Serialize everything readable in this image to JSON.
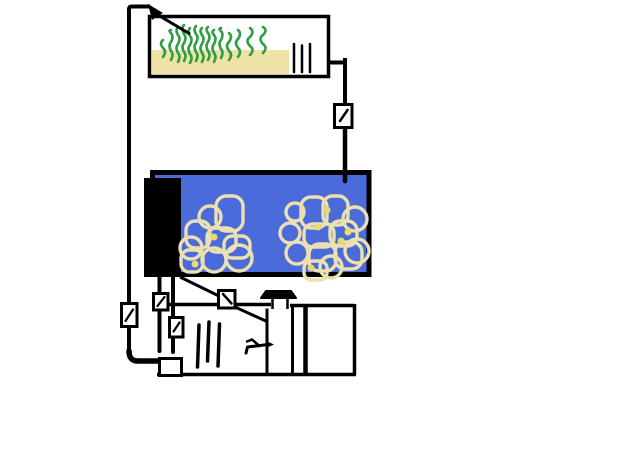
{
  "canvas": {
    "width": 640,
    "height": 461,
    "background": "#ffffff"
  },
  "colors": {
    "line": "#000000",
    "water": "#4a6bd9",
    "substrate": "#efe2a7",
    "rock_outline": "#ebe0af",
    "rock_highlight": "#e8da6e",
    "plant_green": "#2f9e44",
    "box_fill": "#ffffff"
  },
  "plants": [
    {
      "x": 163,
      "y1": 40,
      "y2": 57,
      "a": 4
    },
    {
      "x": 171,
      "y1": 30,
      "y2": 60,
      "a": 3
    },
    {
      "x": 178,
      "y1": 27,
      "y2": 62,
      "a": 3
    },
    {
      "x": 184,
      "y1": 25,
      "y2": 61,
      "a": 3
    },
    {
      "x": 190,
      "y1": 28,
      "y2": 63,
      "a": 3
    },
    {
      "x": 196,
      "y1": 26,
      "y2": 61,
      "a": 3
    },
    {
      "x": 202,
      "y1": 28,
      "y2": 62,
      "a": 3
    },
    {
      "x": 208,
      "y1": 27,
      "y2": 60,
      "a": 3
    },
    {
      "x": 214,
      "y1": 30,
      "y2": 62,
      "a": 3
    },
    {
      "x": 221,
      "y1": 28,
      "y2": 58,
      "a": 3
    },
    {
      "x": 229,
      "y1": 33,
      "y2": 60,
      "a": 4
    },
    {
      "x": 238,
      "y1": 30,
      "y2": 57,
      "a": 4
    },
    {
      "x": 250,
      "y1": 28,
      "y2": 55,
      "a": 5
    },
    {
      "x": 263,
      "y1": 27,
      "y2": 53,
      "a": 5
    }
  ],
  "rocks": {
    "left": [
      {
        "t": "r",
        "x": 216,
        "y": 196,
        "w": 27,
        "h": 35
      },
      {
        "t": "c",
        "x": 210,
        "y": 217,
        "r": 11
      },
      {
        "t": "r",
        "x": 186,
        "y": 221,
        "w": 24,
        "h": 27
      },
      {
        "t": "r",
        "x": 207,
        "y": 228,
        "w": 29,
        "h": 24
      },
      {
        "t": "c",
        "x": 191,
        "y": 248,
        "r": 11
      },
      {
        "t": "r",
        "x": 181,
        "y": 250,
        "w": 22,
        "h": 22
      },
      {
        "t": "c",
        "x": 214,
        "y": 260,
        "r": 12
      },
      {
        "t": "r",
        "x": 224,
        "y": 236,
        "w": 26,
        "h": 22
      },
      {
        "t": "c",
        "x": 239,
        "y": 258,
        "r": 13
      }
    ],
    "right": [
      {
        "t": "c",
        "x": 295,
        "y": 212,
        "r": 9
      },
      {
        "t": "r",
        "x": 301,
        "y": 197,
        "w": 26,
        "h": 31
      },
      {
        "t": "r",
        "x": 323,
        "y": 196,
        "w": 25,
        "h": 29
      },
      {
        "t": "c",
        "x": 355,
        "y": 219,
        "r": 12
      },
      {
        "t": "c",
        "x": 290,
        "y": 233,
        "r": 10
      },
      {
        "t": "r",
        "x": 304,
        "y": 224,
        "w": 30,
        "h": 23
      },
      {
        "t": "r",
        "x": 330,
        "y": 221,
        "w": 27,
        "h": 25
      },
      {
        "t": "c",
        "x": 297,
        "y": 253,
        "r": 11
      },
      {
        "t": "r",
        "x": 309,
        "y": 244,
        "w": 27,
        "h": 27
      },
      {
        "t": "r",
        "x": 335,
        "y": 242,
        "w": 27,
        "h": 27
      },
      {
        "t": "c",
        "x": 357,
        "y": 251,
        "r": 12
      },
      {
        "t": "r",
        "x": 304,
        "y": 261,
        "w": 23,
        "h": 19
      },
      {
        "t": "c",
        "x": 331,
        "y": 267,
        "r": 11
      }
    ],
    "spots": [
      {
        "x": 318,
        "y": 227
      },
      {
        "x": 341,
        "y": 241
      },
      {
        "x": 311,
        "y": 268
      },
      {
        "x": 327,
        "y": 210
      },
      {
        "x": 348,
        "y": 232
      },
      {
        "x": 214,
        "y": 237
      },
      {
        "x": 195,
        "y": 264
      }
    ]
  }
}
